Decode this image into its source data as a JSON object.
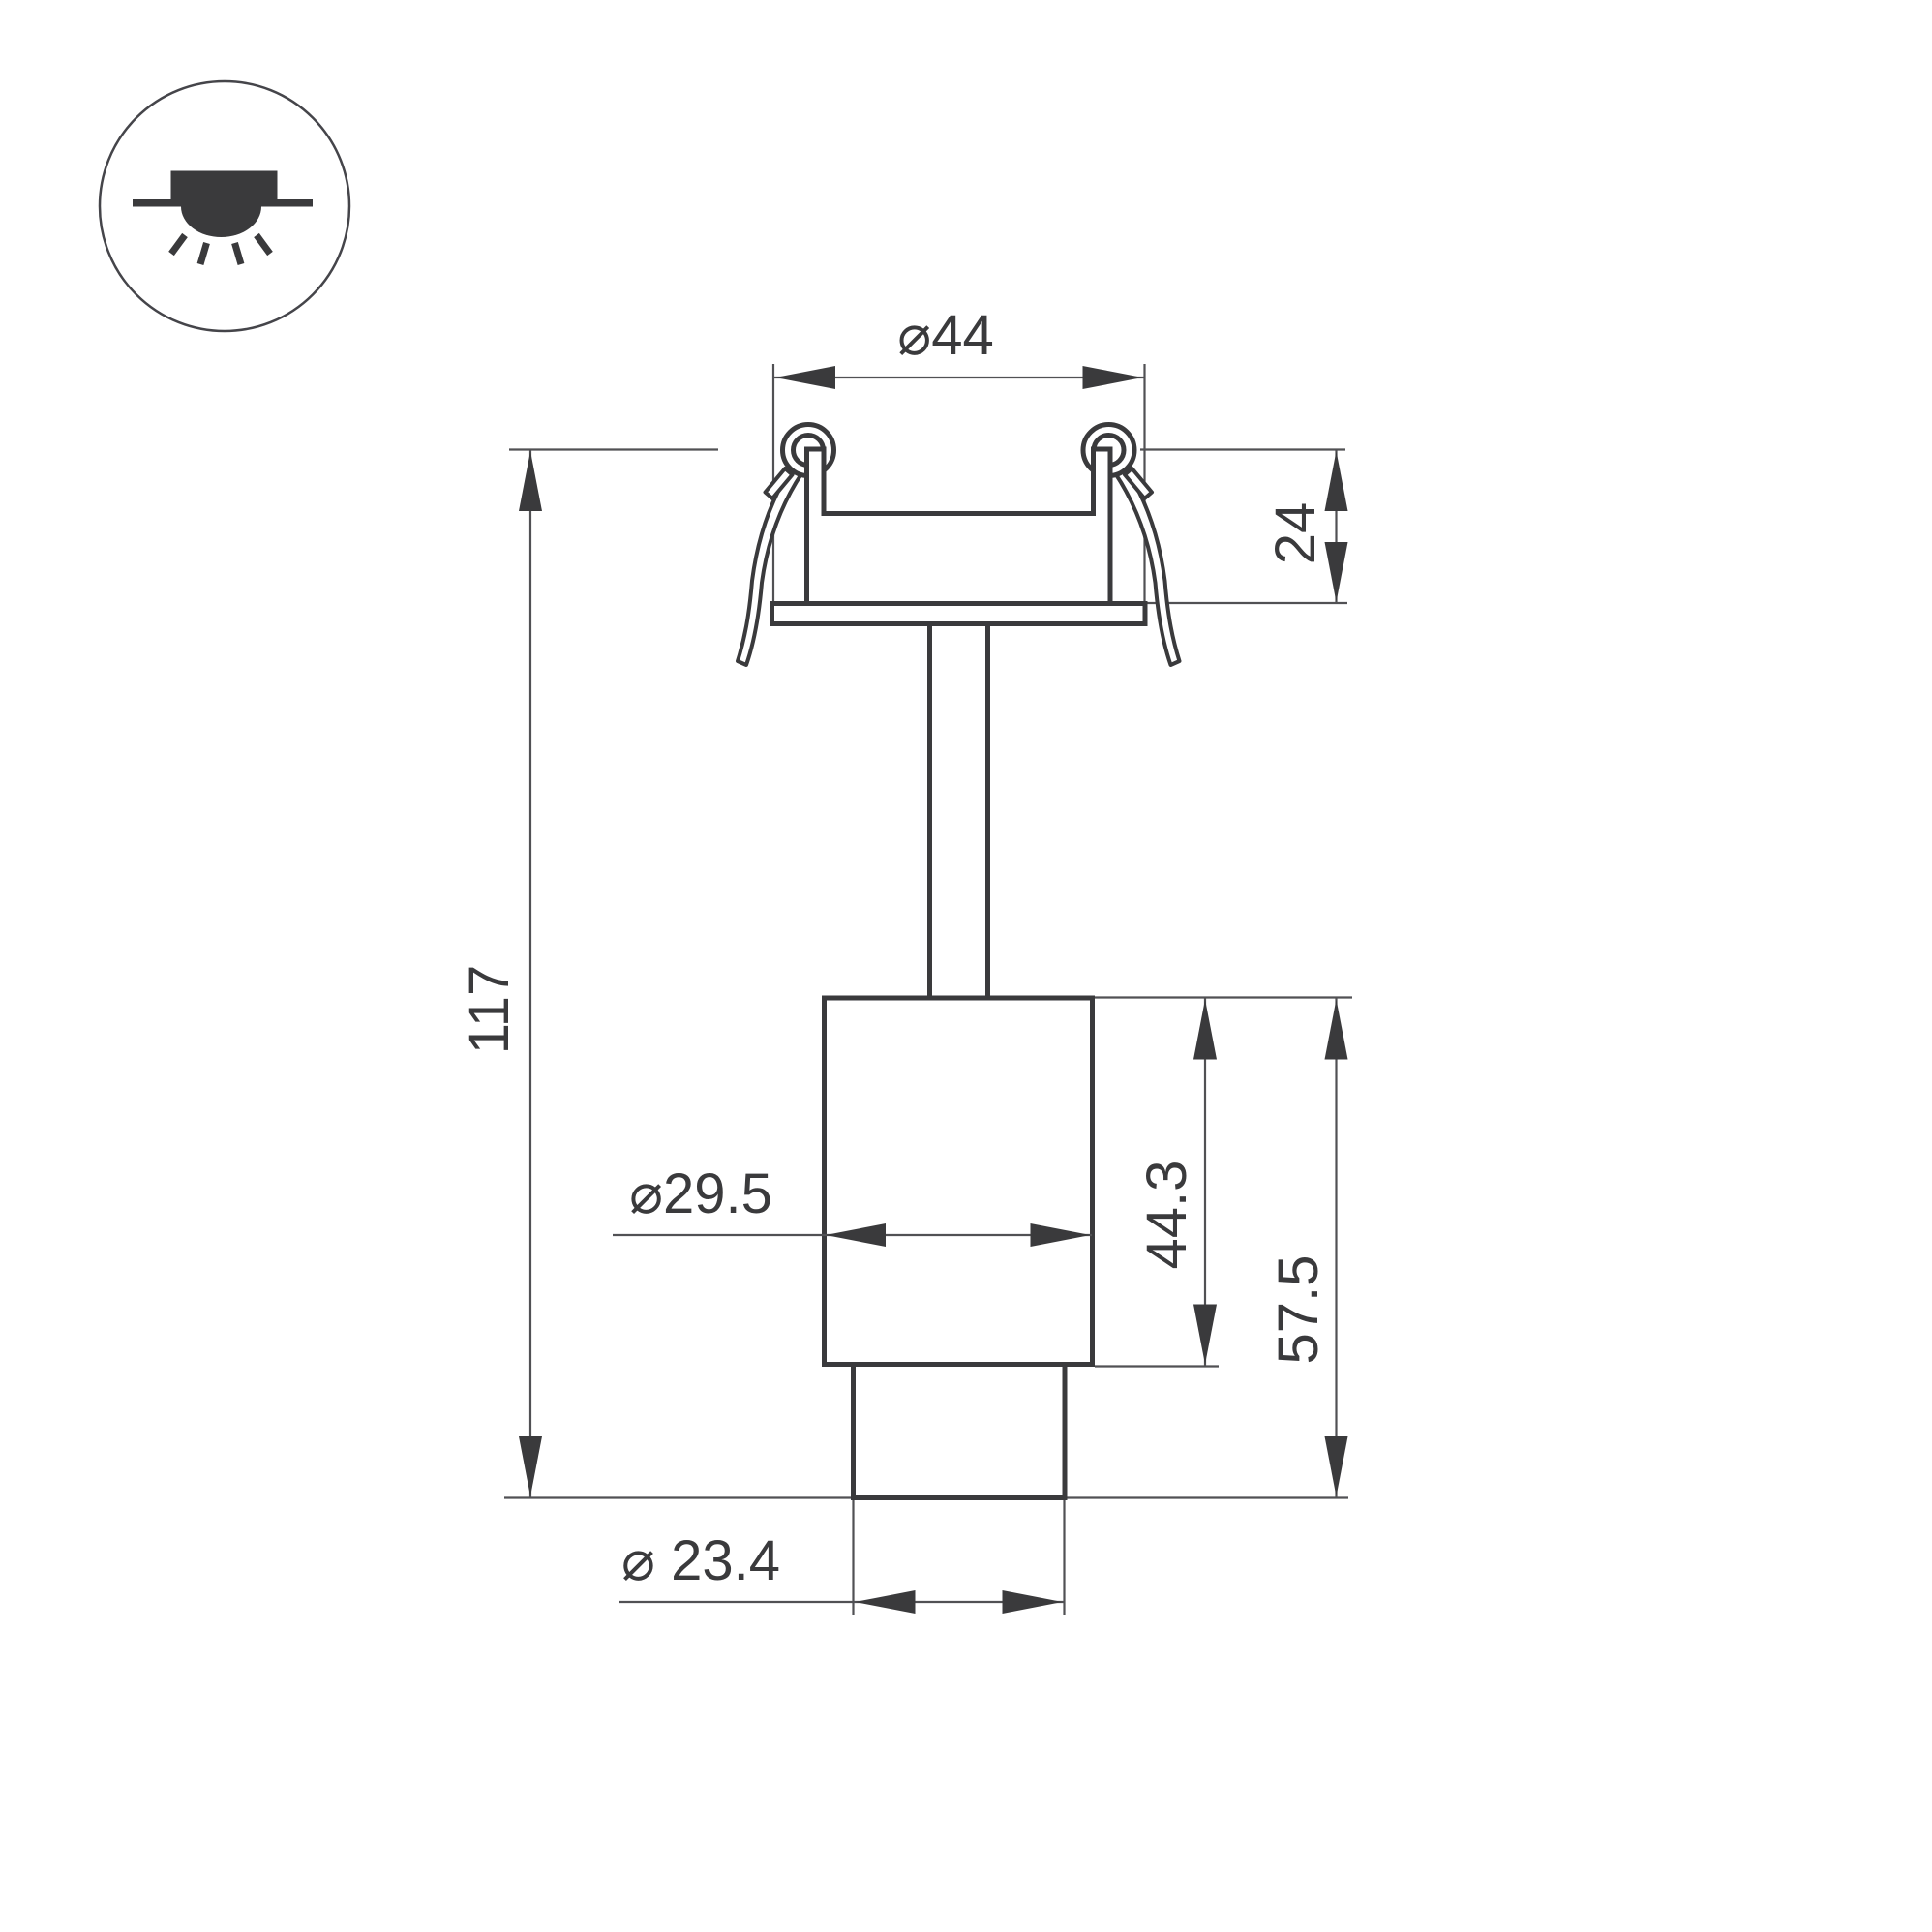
{
  "icon": {
    "name": "recessed-downlight-mounting-icon"
  },
  "drawing": {
    "subject": "recessed-spot-luminaire-section",
    "labels": {
      "top_diameter": "⌀44",
      "recess_depth": "24",
      "total_height": "117",
      "body_diameter": "⌀29.5",
      "body_height": "44.3",
      "lower_section_height": "57.5",
      "tip_diameter": "⌀ 23.4"
    }
  },
  "colors": {
    "background": "#ffffff",
    "thick_line": "#3a3a3c",
    "thin_line": "#515154",
    "text": "#3a3a3c"
  }
}
